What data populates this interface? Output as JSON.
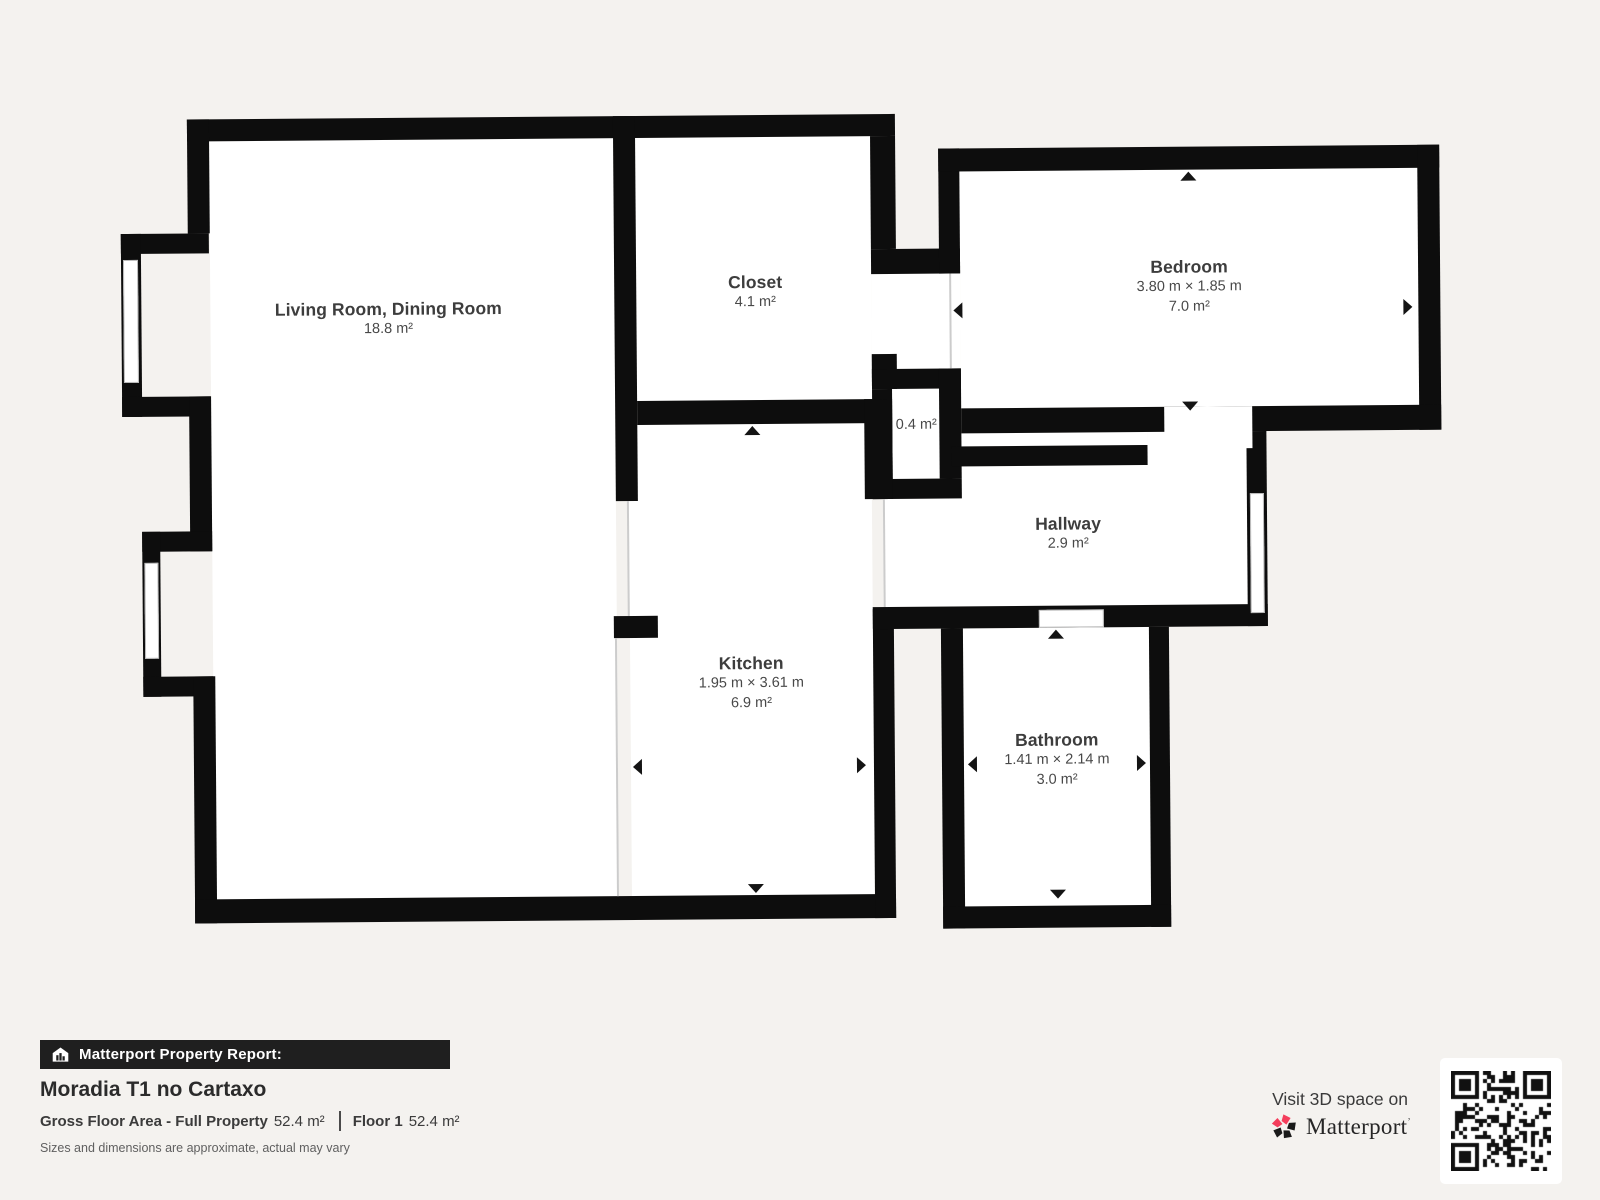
{
  "floorplan": {
    "rooms": [
      {
        "id": "living-room",
        "name": "Living Room, Dining Room",
        "area": "18.8 m²"
      },
      {
        "id": "closet",
        "name": "Closet",
        "area": "4.1 m²"
      },
      {
        "id": "bedroom",
        "name": "Bedroom",
        "dims": "3.80 m × 1.85 m",
        "area": "7.0 m²"
      },
      {
        "id": "hallway",
        "name": "Hallway",
        "area": "2.9 m²"
      },
      {
        "id": "kitchen",
        "name": "Kitchen",
        "dims": "1.95 m × 3.61 m",
        "area": "6.9 m²"
      },
      {
        "id": "bathroom",
        "name": "Bathroom",
        "dims": "1.41 m × 2.14 m",
        "area": "3.0 m²"
      },
      {
        "id": "small-closet",
        "area": "0.4 m²"
      }
    ]
  },
  "report": {
    "bar_label": "Matterport Property Report:",
    "property_title": "Moradia T1 no Cartaxo",
    "gross_floor_area_label": "Gross Floor Area - Full Property",
    "gross_floor_area_value": "52.4 m²",
    "floor_label": "Floor 1",
    "floor_value": "52.4 m²",
    "disclaimer": "Sizes and dimensions are approximate, actual may vary"
  },
  "branding": {
    "visit_text": "Visit 3D space on",
    "brand_name": "Matterport",
    "brand_pink": "#f43e5c",
    "wall_color": "#0d0d0d"
  }
}
